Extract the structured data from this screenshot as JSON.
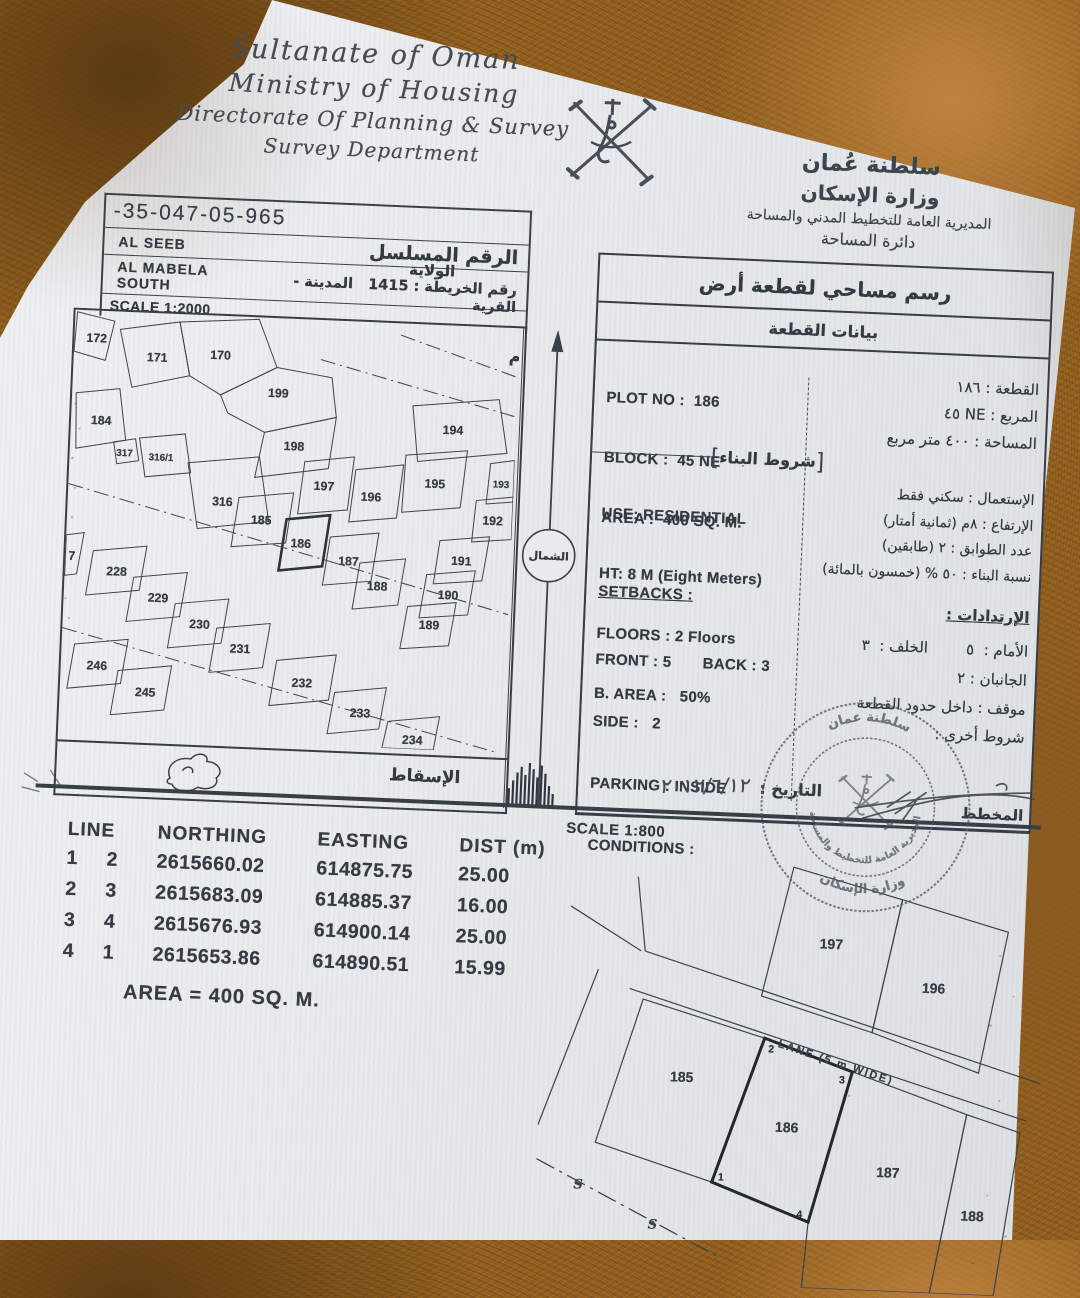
{
  "doc": {
    "header": {
      "script_lines": [
        "Sultanate of Oman",
        "Ministry of Housing",
        "Directorate Of Planning & Survey",
        "Survey Department"
      ],
      "ministry_ar": [
        "سلطنة عُمان",
        "وزارة الإسكان",
        "المديرية العامة للتخطيط المدني والمساحة",
        "دائرة المساحة"
      ]
    },
    "serial": {
      "number": "-35-047-05-965",
      "serial_label_ar": "الرقم المسلسل",
      "wilaya": "AL SEEB",
      "wilaya_label_ar": "الولاية",
      "town": "AL MABELA SOUTH",
      "town_label_ar": "المدينة - القرية",
      "map_no_ar": "رقم الخريطة : 1415",
      "scale": "SCALE 1:2000"
    },
    "overview_map": {
      "site_label_ar": "الموقع العام",
      "projection_label_ar": "الإسقاط",
      "north_label_ar": "الشمال",
      "plots": [
        "172",
        "171",
        "170",
        "199",
        "184",
        "198",
        "317",
        "316/1",
        "316",
        "197",
        "196",
        "195",
        "194",
        "193",
        "192",
        "185",
        "186",
        "187",
        "188",
        "191",
        "190",
        "189",
        "7",
        "228",
        "229",
        "230",
        "231",
        "246",
        "245",
        "232",
        "233",
        "234"
      ]
    },
    "plot_info": {
      "title_ar": "رسم مساحي لقطعة أرض",
      "subtitle_ar": "بيانات القطعة",
      "en_top": [
        "PLOT NO :  186",
        "BLOCK :  45 NE",
        "AREA :  400 SQ. M."
      ],
      "conditions_bracket_ar": "شروط البناء",
      "en_mid": [
        "USE: RESIDENTIAL",
        "HT: 8 M (Eight Meters)",
        "FLOORS : 2 Floors",
        "B. AREA :   50%"
      ],
      "setbacks_en": "SETBACKS :",
      "en_bot": [
        "FRONT : 5       BACK : 3",
        "SIDE :   2",
        "PARKING : INSIDE",
        "CONDITIONS :"
      ],
      "ar_top": [
        "القطعة :  ١٨٦",
        "المربع :  NE ٤٥",
        "المساحة :  ٤٠٠ متر مربع"
      ],
      "ar_mid": [
        "الإستعمال :  سكني فقط",
        "الإرتفاع :  ٨م  (ثمانية أمتار)",
        "عدد الطوابق :  ٢  (طابقين)",
        "نسبة البناء :  ٥٠ %  (خمسون بالمائة)"
      ],
      "setbacks_ar": "الإرتدادات :",
      "ar_bot": [
        "الأمام :  ٥        الخلف :  ٣",
        "الجانبان :  ٢",
        "موقف :  داخل حدود القطعة",
        "شروط أخرى :"
      ],
      "date_label_ar": "التاريخ :",
      "date_value": "٢٠١٢/٦/١٢",
      "planner_label_ar": "المخطط"
    },
    "stamp": {
      "top": "سلطنة عمان",
      "bottom": "وزارة الإسكان",
      "inner": "المديرية العامة للتخطيط والمساحة"
    },
    "coords_table": {
      "headers": [
        "LINE",
        "NORTHING",
        "EASTING",
        "DIST (m)"
      ],
      "rows": [
        [
          "1",
          "2",
          "2615660.02",
          "614875.75",
          "25.00"
        ],
        [
          "2",
          "3",
          "2615683.09",
          "614885.37",
          "16.00"
        ],
        [
          "3",
          "4",
          "2615676.93",
          "614900.14",
          "25.00"
        ],
        [
          "4",
          "1",
          "2615653.86",
          "614890.51",
          "15.99"
        ]
      ],
      "area_line": "AREA = 400 SQ. M."
    },
    "detail_map": {
      "scale": "SCALE 1:800",
      "lane_label": "LANE (5 m WIDE)",
      "plots": [
        "197",
        "196",
        "185",
        "186",
        "187",
        "188"
      ],
      "corners": [
        "2",
        "3",
        "1",
        "4"
      ],
      "sewer_marks": [
        "S",
        "S"
      ]
    }
  }
}
